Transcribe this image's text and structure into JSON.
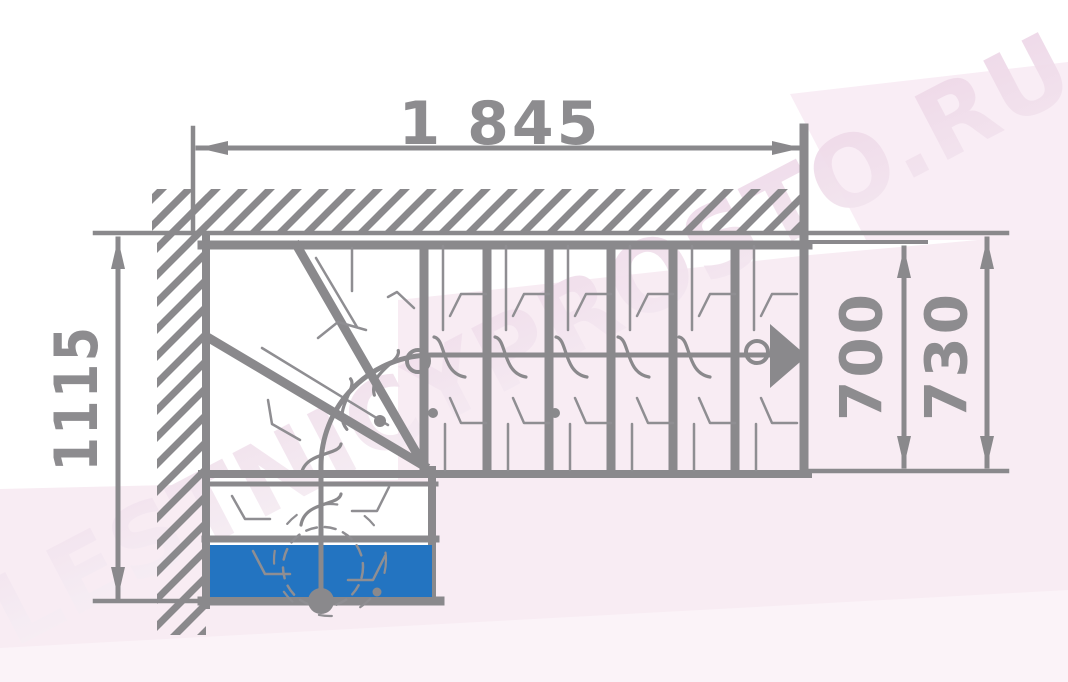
{
  "watermark": {
    "text": "LESTNICYPROSTO.RU"
  },
  "dimensions": {
    "overall_width": "1 845",
    "overall_depth": "1115",
    "flight_width_inner": "700",
    "flight_width_outer": "730"
  },
  "colors": {
    "background": "#ffffff",
    "line": "#8a898c",
    "thin_line": "#8f8e92",
    "dim_text": "#8d8c8f",
    "step_highlight": "#2374c1",
    "pink_band": "#f8ecf3",
    "pink_band_corner": "#f9edf5",
    "pink_band_light": "#fbf3f8",
    "watermark_start": "#f7f1f6",
    "watermark_end": "#eed7e7"
  }
}
